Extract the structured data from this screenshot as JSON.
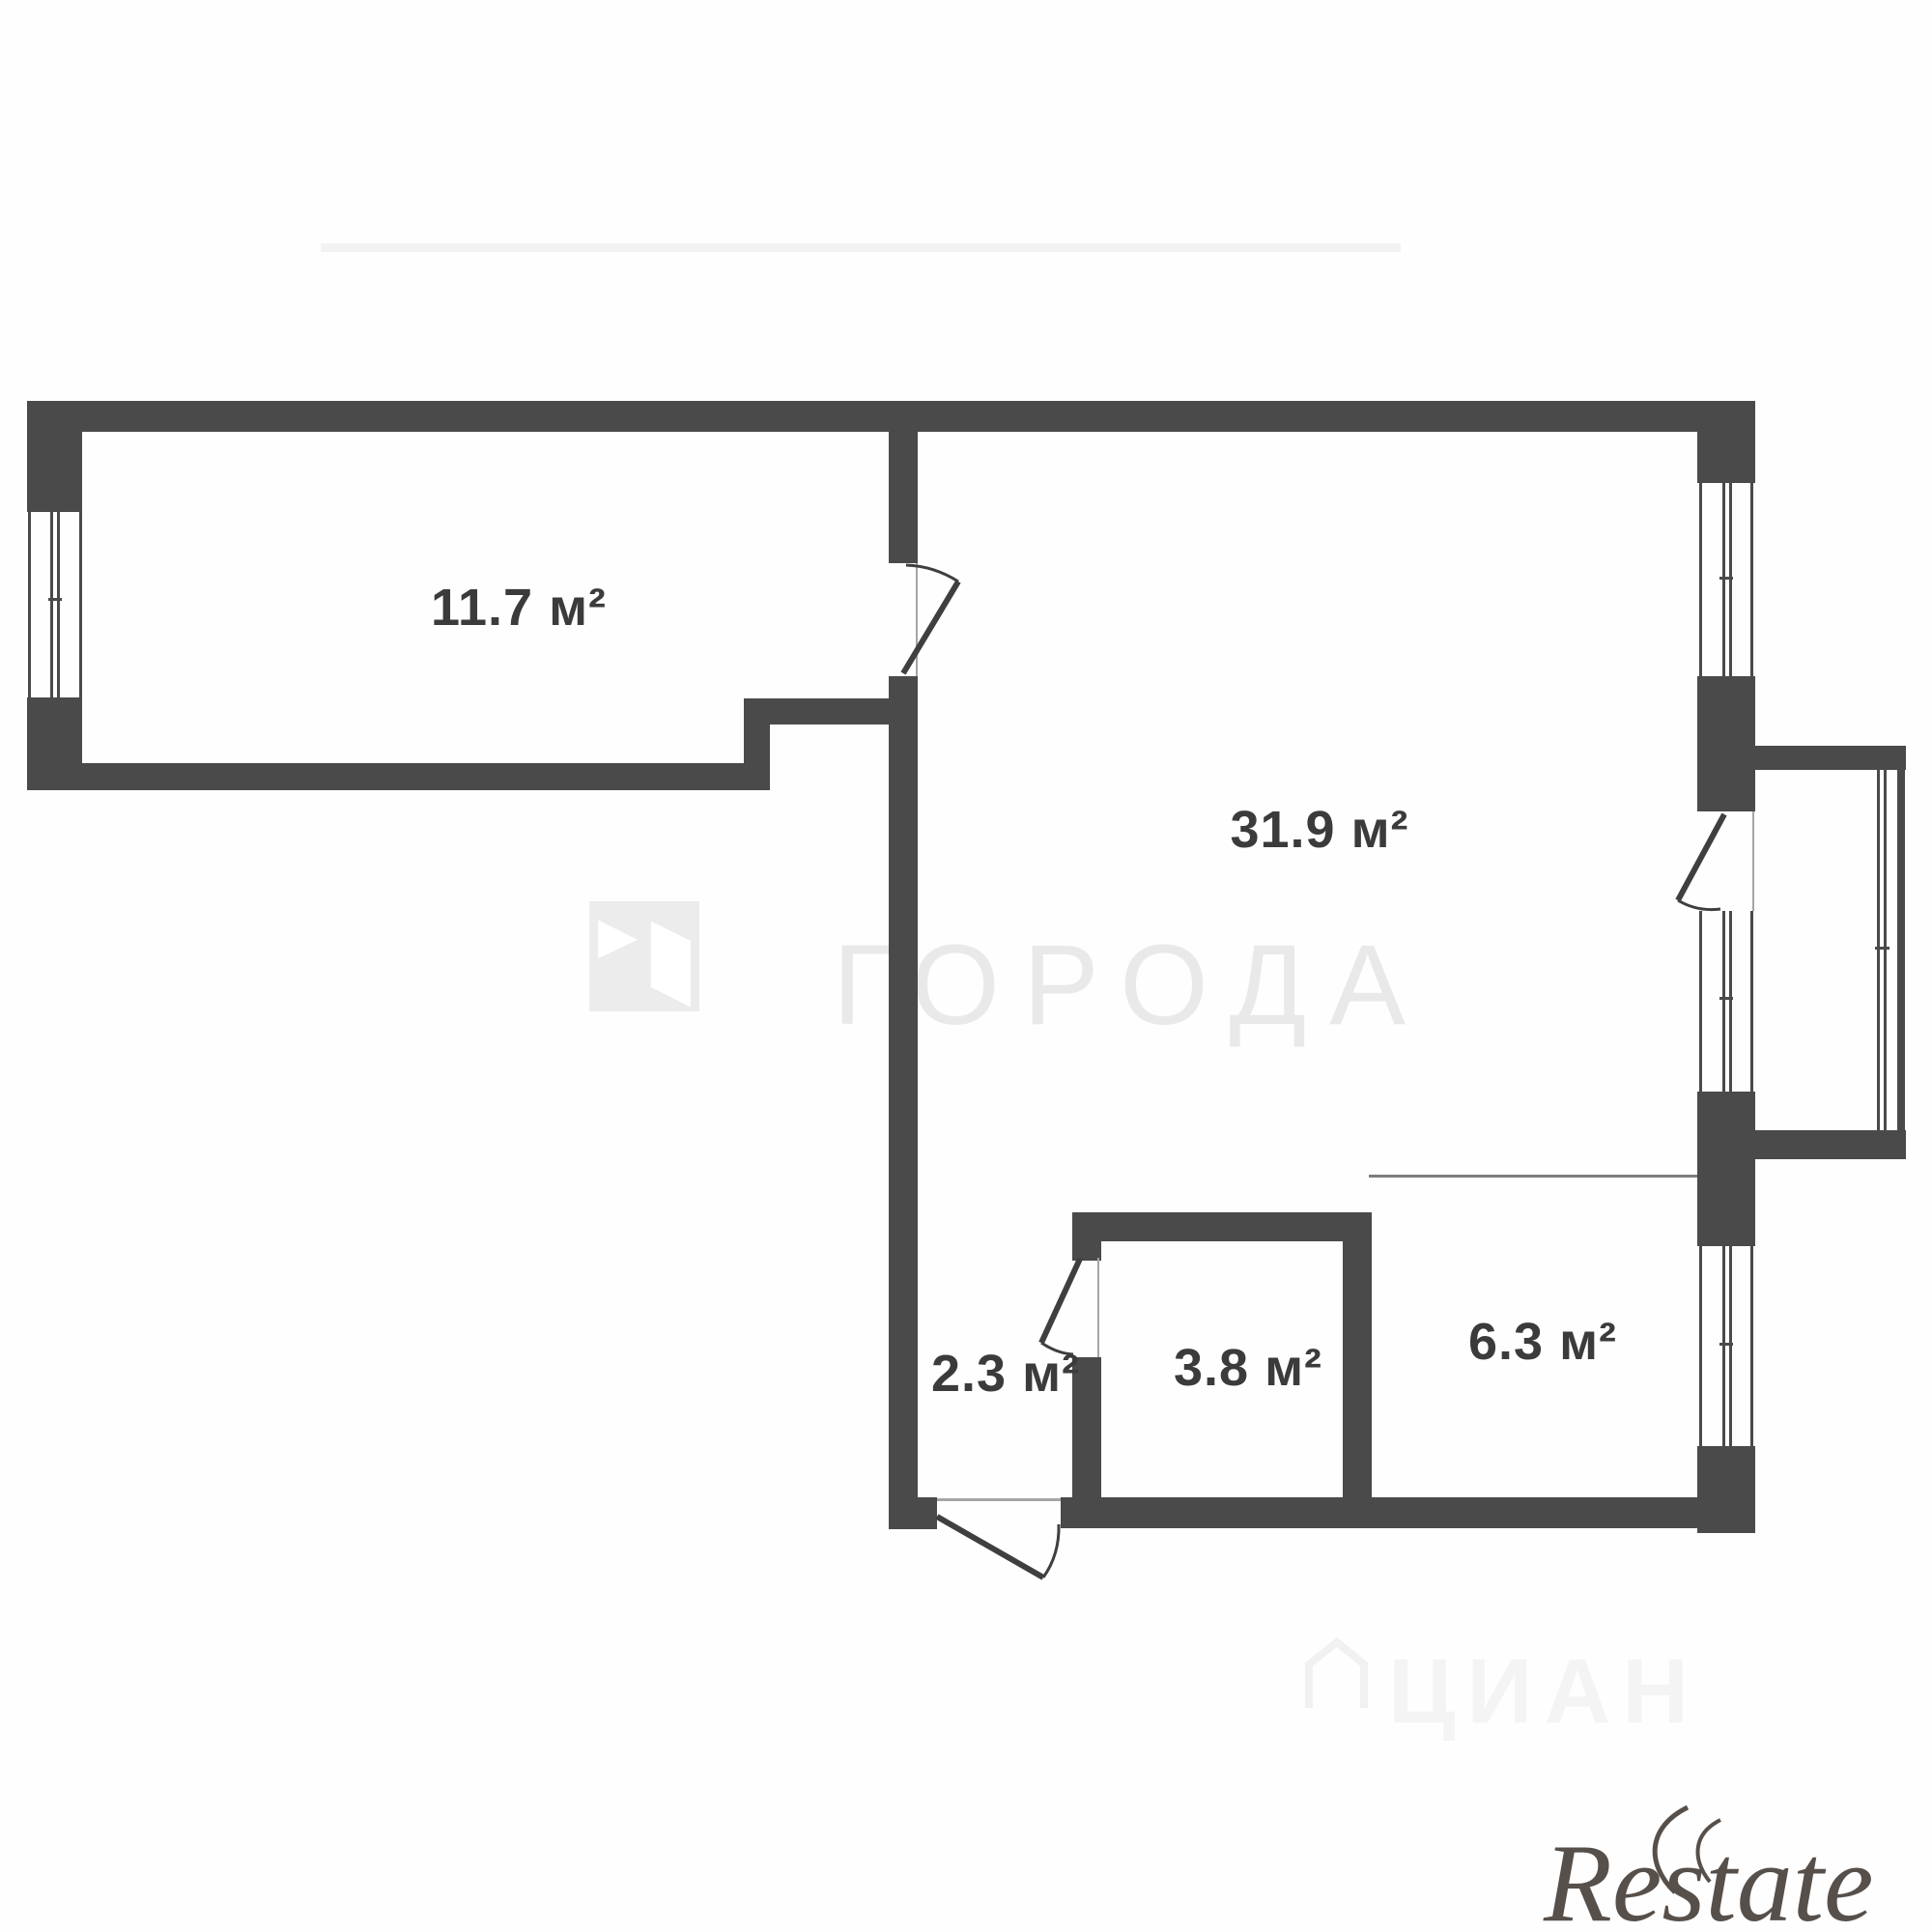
{
  "meta": {
    "type": "apartment-floor-plan"
  },
  "rooms": [
    {
      "name": "room-1",
      "label": "11.7 м²"
    },
    {
      "name": "living-room",
      "label": "31.9 м²"
    },
    {
      "name": "hallway",
      "label": "2.3 м²"
    },
    {
      "name": "bathroom",
      "label": "3.8 м²"
    },
    {
      "name": "kitchen",
      "label": "6.3 м²"
    }
  ],
  "watermarks": {
    "agency_logo_text": "ГОРОДА",
    "portal_text": "ЦИАН",
    "corner_logo_text": "Restate"
  },
  "colors": {
    "wall": "#4a4a4a",
    "label": "#3b3b3b",
    "agency_watermark": "#e9e9e9",
    "portal_watermark": "#f4f4f4",
    "corner_logo": "#564f4a",
    "background": "#fefefe"
  }
}
